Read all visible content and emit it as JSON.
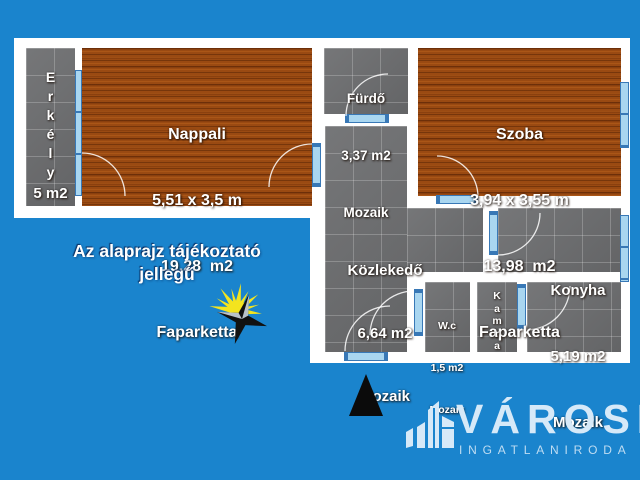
{
  "note": {
    "line1": "Az alaprajz tájékoztató",
    "line2": "jellegű"
  },
  "rooms": {
    "erkely": {
      "letters": [
        "E",
        "r",
        "k",
        "é",
        "l",
        "y"
      ],
      "area": "5 m2"
    },
    "nappali": {
      "name": "Nappali",
      "dims": "5,51 x 3,5 m",
      "area": "19,28  m2",
      "floor": "Faparketta"
    },
    "furdo": {
      "name": "Fürdő",
      "area": "3,37 m2",
      "floor": "Mozaik"
    },
    "szoba": {
      "name": "Szoba",
      "dims": "3,94 x 3,55 m",
      "area": "13,98  m2",
      "floor": "Faparketta"
    },
    "kozlekedo": {
      "name": "Közlekedő",
      "area": "6,64 m2",
      "floor": "Mozaik"
    },
    "konyha": {
      "name": "Konyha",
      "area": "5,19 m2",
      "floor": "Mozaik"
    },
    "wc": {
      "name": "W.c",
      "area": "1,5 m2",
      "floor": "Mozaik"
    },
    "kamra": {
      "letters": [
        "K",
        "a",
        "m",
        "r",
        "a"
      ]
    }
  },
  "logo": {
    "title": "VÁROSI",
    "subtitle": "INGATLANIRODA"
  },
  "icons": {
    "sun": "sun-icon",
    "north_arrow": "north-arrow-icon",
    "logo_buildings": "logo-buildings-icon"
  },
  "colors": {
    "background": "#1a84cd",
    "wall": "#ffffff",
    "wood_floor": "#9a4a12",
    "tile_floor": "#6d6e70",
    "window_fill": "#a9d6f0",
    "window_border": "#3878b6",
    "label_text": "#ffffff",
    "logo_text": "#d6e9f8",
    "sun_yellow": "#f3e41f",
    "star_black": "#111111",
    "north_arrow_black": "#0b0b0b"
  }
}
